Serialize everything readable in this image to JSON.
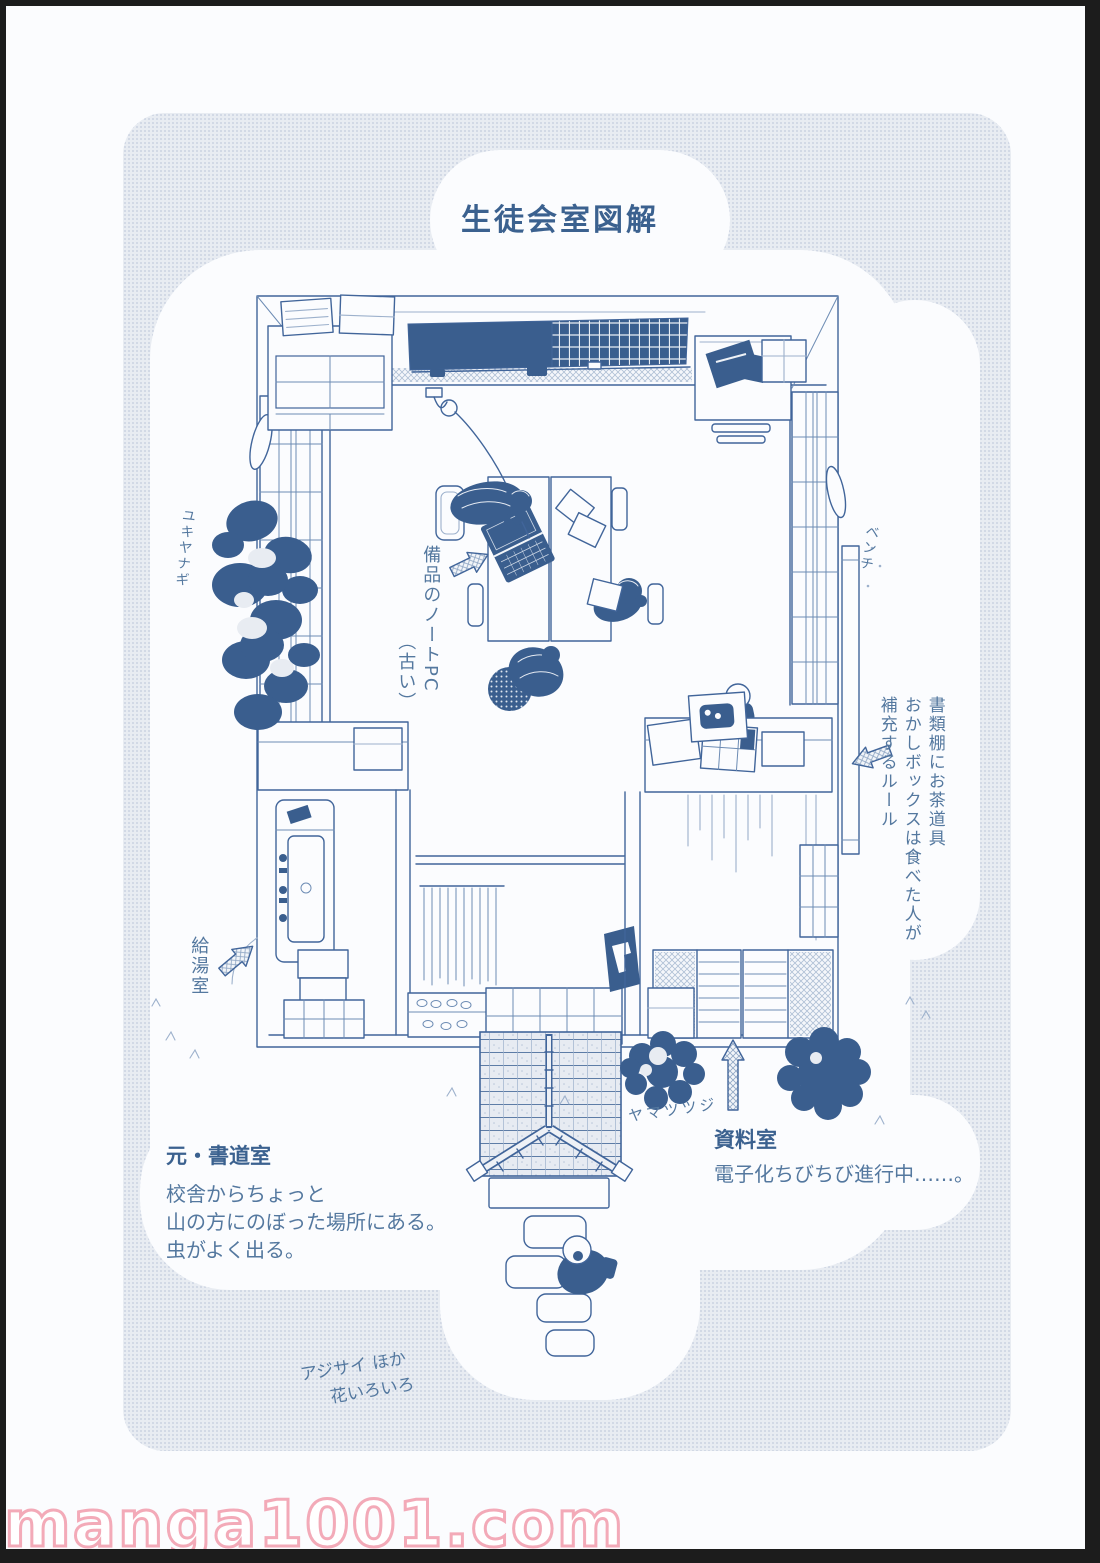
{
  "page": {
    "title": "生徒会室図解",
    "watermark": "manga1001.com"
  },
  "labels": {
    "tree": "ユキヤナギ",
    "laptop1": "備品のノートPC",
    "laptop2": "（古い）",
    "bench": "ベンチ",
    "rule1": "書類棚にお茶道具",
    "rule2": "おかしボックスは食べた人が",
    "rule3": "補充するルール",
    "kitchen": "給湯室",
    "bush": "ヤマツツジ",
    "room_heading": "元・書道室",
    "room_line1": "校舎からちょっと",
    "room_line2": "山の方にのぼった場所にある。",
    "room_line3": "虫がよく出る。",
    "archive_heading": "資料室",
    "archive_line1": "電子化ちびちび進行中……。",
    "flowers1": "アジサイ ほか",
    "flowers2": "花いろいろ"
  },
  "icons": {
    "arrows": [
      "laptop-arrow",
      "kitchen-arrow",
      "snack-rule-arrow",
      "archive-arrow"
    ],
    "style": "hand-drawn hatched arrow"
  },
  "colors": {
    "ink": "#41659a",
    "ink-dark": "#3a5e8e",
    "ink-mid": "#6d8cb4",
    "ink-light": "#9db1cc",
    "paper": "#fbfcfe",
    "halftone": "#e8ecf2",
    "halftone-dot": "#ccd4e2",
    "title": "#3b618f",
    "text": "#54789f",
    "watermark-pink": "#f3aab8",
    "frame-black": "#1c1c1c"
  }
}
